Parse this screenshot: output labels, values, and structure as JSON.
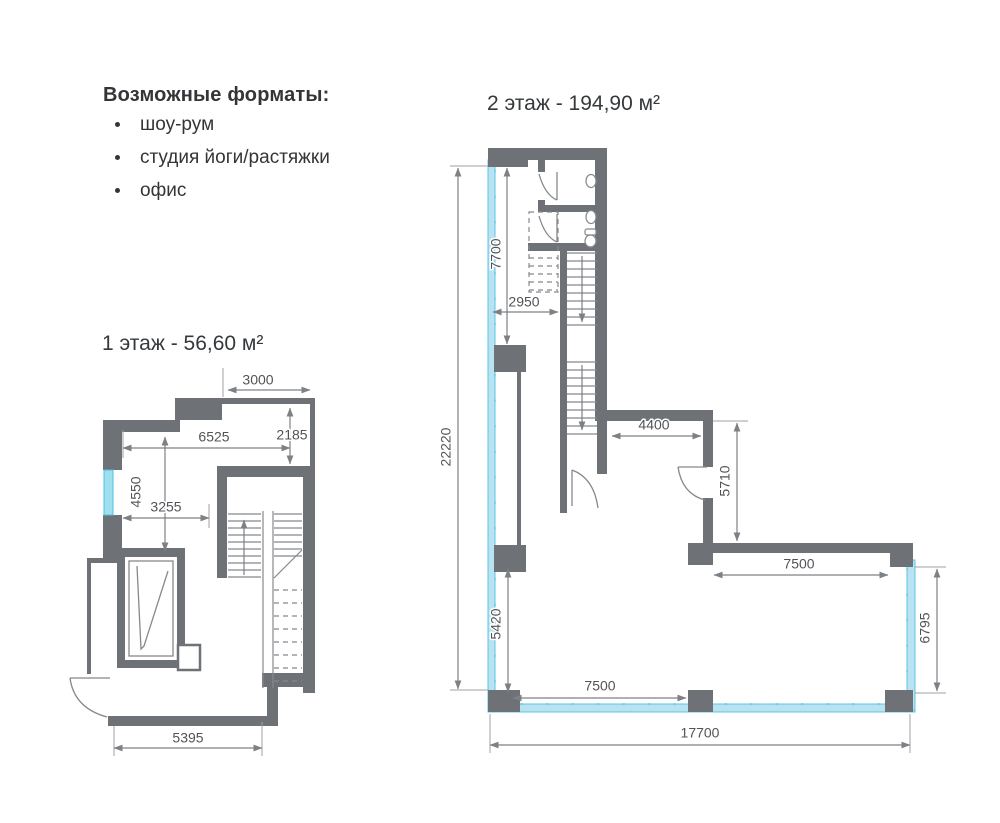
{
  "header": {
    "title": "Возможные форматы:",
    "items": [
      "шоу-рум",
      "студия йоги/растяжки",
      "офис"
    ]
  },
  "floor1": {
    "title": "1 этаж - 56,60 м²",
    "dims": {
      "top": "3000",
      "width": "6525",
      "niche": "2185",
      "left_height": "4550",
      "mid": "3255",
      "bottom": "5395"
    }
  },
  "floor2": {
    "title": "2 этаж - 194,90 м²",
    "dims": {
      "overall_height": "22220",
      "glazing_top": "7700",
      "corridor": "2950",
      "hall": "4400",
      "room_right": "5710",
      "terrace_top": "7500",
      "right_height": "6795",
      "left_bottom": "5420",
      "bottom_span": "7500",
      "overall_width": "17700"
    }
  },
  "colors": {
    "wall": "#6e7276",
    "dimension_line": "#7d8084",
    "dimension_text": "#515457",
    "title_text": "#333538",
    "glazing_fill": "#b9e3f1",
    "glazing_stroke": "#59c5e4",
    "window_fill": "#9fdff0"
  }
}
